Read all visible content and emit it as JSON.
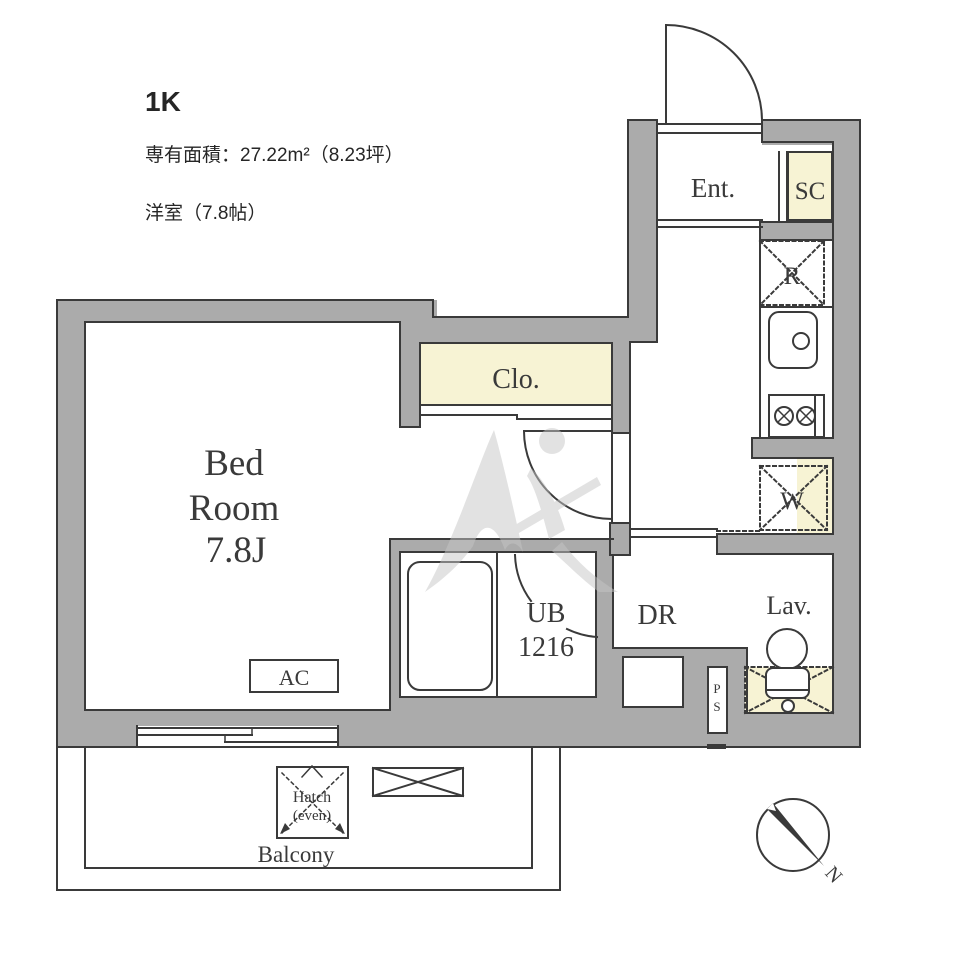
{
  "header": {
    "plan_type": "1K",
    "area_text": "専有面積：27.22m²（8.23坪）",
    "room_text": "洋室（7.8帖）"
  },
  "labels": {
    "entrance": "Ent.",
    "shoe_closet": "SC",
    "refrigerator_space": "R",
    "washer_space": "W",
    "closet": "Clo.",
    "bedroom_line1": "Bed",
    "bedroom_line2": "Room",
    "bedroom_line3": "7.8J",
    "unit_bath_line1": "UB",
    "unit_bath_line2": "1216",
    "dressing_room": "DR",
    "lavatory": "Lav.",
    "pipe_space_letter1": "P",
    "pipe_space_letter2": "S",
    "air_conditioner": "AC",
    "hatch_line1": "Hatch",
    "hatch_line2": "(even)",
    "balcony": "Balcony",
    "compass_north": "N"
  },
  "colors": {
    "wall": "#ababab",
    "outline": "#3a3a3a",
    "fixture_highlight": "#f7f3d4",
    "watermark": "#c6c6c6",
    "background": "#ffffff"
  }
}
